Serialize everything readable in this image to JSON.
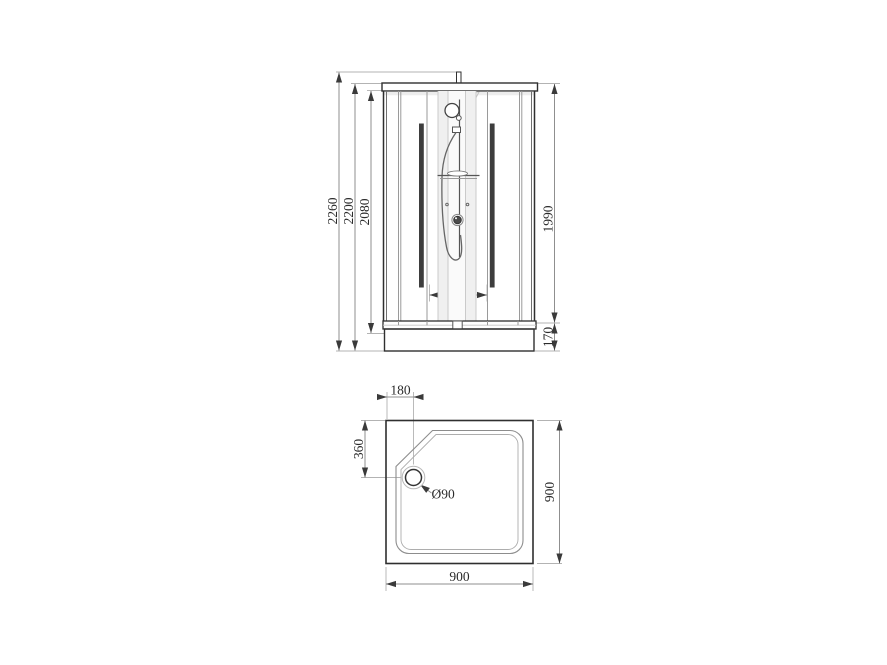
{
  "drawing": {
    "front_view": {
      "dimensions": {
        "overall_height_mm": "2260",
        "cabin_height_mm": "2200",
        "inner_height_mm": "2080",
        "glass_height_mm": "1990",
        "tray_height_mm": "170",
        "column_width_mm": "420"
      }
    },
    "plan_view": {
      "dimensions": {
        "drain_offset_left_mm": "180",
        "drain_offset_top_mm": "360",
        "drain_diameter": "Ø90",
        "depth_mm": "900",
        "width_mm": "900"
      }
    },
    "colors": {
      "background": "#ffffff",
      "outline": "#2f2f2f",
      "dimension_line": "#8f8f8f",
      "extension_line": "#b3b3b3",
      "arrow": "#3a3a3a",
      "text": "#2b2b2b",
      "handle_bar": "#3d3d3d"
    }
  }
}
